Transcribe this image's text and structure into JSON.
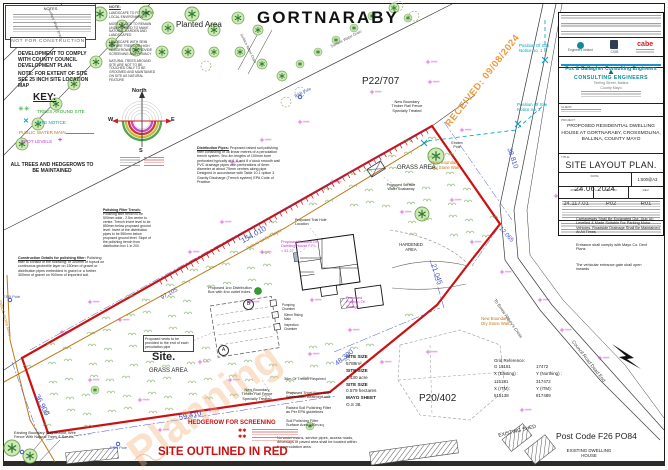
{
  "colors": {
    "red": "#cc1111",
    "blue_dim": "#4053c8",
    "cyan": "#00a0c0",
    "magenta": "#c433c4",
    "orange": "#c07818",
    "green_dark": "#2c7a2c",
    "green_fill": "#cfe8b8",
    "green_line": "#77aa55",
    "road": "#3a3a3a"
  },
  "header": {
    "townland": "GORTNARABY",
    "planted_area": "Planted Area"
  },
  "stamps": {
    "not_for_construction": "NOT FOR CONSTRUCTION",
    "received": "RECEIVED: 09/08/2024",
    "planning_watermark": "Planning"
  },
  "notes_box": {
    "title": "NOTES"
  },
  "dev_note": "DEVELOPMENT TO COMPLY WITH COUNTY COUNCIL DEVELOPMENT PLAN.",
  "extent_note": "NOTE: FOR EXTENT OF SITE SEE 25 INCH SITE LOCATION MAP",
  "key": {
    "title": "KEY:",
    "trees": "TREES AROUND SITE",
    "site_notice": "SITE NOTICE",
    "water_main": "PUBLIC WATER MAIN",
    "spot_levels": "SPOT LEVELS"
  },
  "trees_note": "ALL TREES AND HEDGEROWS TO BE MAINTAINED",
  "landscape_note": {
    "title": "NOTE:",
    "p1": "LANDSCAPE TO FIT IN WITH LOCAL ENVIRONMENT",
    "p2": "MOST OF SITE TO REMAIN UNDISTURBED TO MAKE NATURAL GARDEN AND LANDSCAPED",
    "p3": "LANDSCAPE WITH SEMI MATURE TREES OR HIGH HEDGEROWS TO PROVIDE SCREENING AND PRIVACY",
    "p4": "NATURAL TREES AROUND SITE ARE NOT TO BE TOUCHED ONLY TO BE GROOMED AND MAINTAINED ON SITE AS NATURAL FEATURE"
  },
  "compass": {
    "north_label": "North",
    "west": "W",
    "east": "E",
    "south": "S"
  },
  "notes": {
    "distribution_title": "Distribution Pipes:",
    "distribution_body": "Proposed raised soil polishing filter consisting of 36 linear metres of a percolation trench system. 9no 4m lengths of 100mm bore perforated typically at 4, 6 and 8 o'clock smooth wall PVC drainage pipes with perforations of 6mm diameter at about 75mm centres along pipe. Designed in accordance with Table 10.1 option 3 Gravity Discharge (Trench system) EPA Code of Practise.",
    "polishing_title": "Polishing Filter Trench:",
    "polishing_body": "Polishing filter trench to be 500mm wide - 2.5m centre to centre. Trench Invert level to be 850mm below proposed ground level. Invert of the distribution pipes to be 550mm below proposed ground level. Slope of the polishing trench from distribution box 1 in 200.",
    "construction_title": "Construction Details for polishing filter:",
    "construction_body": "Polishing filter to consist of the following: of 300mm of topsoil on continuous geotextile layer on 150mm of gravel or distribution pipes embedded in gravel or a further 300mm of gravel on 900mm of imported soil."
  },
  "parcels": {
    "p22": "P22/707",
    "p20": "P20/402"
  },
  "dims": {
    "road_frontage": "154.010",
    "nw": "97.105",
    "south": "59.410",
    "west": "36.900",
    "southeast": "48.390",
    "east": "21.045",
    "northeast": "38.810",
    "ne_short": "12.065"
  },
  "site": {
    "label": "Site.",
    "grass_area": "GRASS AREA",
    "hardened_area": "HARDENED AREA",
    "outlined": "SITE OUTLINED IN RED"
  },
  "labels": {
    "surface_water_drain": "Surface Water Drain",
    "esb_pole": "ESB Pole",
    "eircom_pole": "Eircom Pole",
    "new_boundary_fence": "New Boundary Timber Rail Fence Specially Treated",
    "dry_stone_wall": "New Boundary Dry Stone Wall",
    "soakaway": "Proposed Surface Water Soakaway",
    "dwelling": "Proposed Position Of Dwelling House F.F.L = 51.27",
    "garage": "Proposed Position Of Garage",
    "trial_hole": "Proposed Trial Hole Location",
    "dist_box": "Proposed 1no Distribution Box with 4no outlet holes.",
    "vents": "Proposed vents to be provided to the end of each percolation pipe",
    "pumping_chamber": "Pumping Chamber",
    "rising_main": "50mm Rising Main",
    "inspection_chamber": "Inspection Chamber",
    "a": "A",
    "b": "B",
    "site_notice1": "Position Of Site Notice no. 1",
    "site_notice2": "Position Of Site Notice no. 2",
    "council_road": "Council Road Dead End",
    "to_cross": "To Errew Abbey's Cross",
    "existing_shed": "EXISTING SHED",
    "existing_dwelling": "EXISTING DWELLING HOUSE",
    "post_code": "Post Code F26 PO84",
    "existing_boundary": "Existing Boundary Clay Mound, Wire Fence With Natural Trees & Scrubs.",
    "hedgerow": "HEDGEROW FOR SCREENING",
    "trench_req": "36m Of Trench Required",
    "treatment_unit": "Proposed Tricel Novo IE6+ Wastewater treatment unit",
    "raised_filter": "Raised Soil Polishing Filter as Per EPA guidelines",
    "filter_area": "Soil Polishing Filter Surface Area 140m.sq",
    "no_services": "No water mains, service pipes, access roads, driveways or paved area shall be located within the percolation area.",
    "carriageway": "Carriageway Shall Be Excavated Out, Dug Up Levelled & Made Suitable For Parking Motor Vehicles. Roadside Drainage Shall Be Maintained At All Times",
    "entrance": "Entrance shall comply with Mayo Co. Devt Plans",
    "gate": "The vehicular entrance gate shall open inwards"
  },
  "site_size": {
    "r1l": "SITE SIZE",
    "r1v": "5788m²",
    "r2l": "SITE SIZE",
    "r2v": "1.430 acre",
    "r3l": "SITE SIZE",
    "r3v": "0.579 hectares",
    "r4l": "MAYO SHEET",
    "r4v": "O.S 38."
  },
  "grid_reference": {
    "title": "Grid Reference:",
    "c1": "G 15181",
    "c2": "17472",
    "c3": "X (Easting) :",
    "c4": "Y (Northing) :",
    "c5": "115181",
    "c6": "317472",
    "c7": "X (ITM):",
    "c8": "Y (ITM):",
    "c9": "515138",
    "c10": "817489"
  },
  "title_block": {
    "firm": "Fox & Gallagher Consulting Engineers",
    "org": "CONSULTING ENGINEERS",
    "address1": "Teeling Street, Ballina",
    "address2": "County Mayo",
    "logo1": "Engineers Ireland",
    "logo2": "CIOB",
    "logo3": "cabe",
    "client_label": "CLIENT:",
    "project_label": "PROJECT:",
    "project": "PROPOSED RESIDENTIAL DWELLING HOUSE AT GORTNARABY, CROSSMOLINA, BALLINA, COUNTY MAYO",
    "title_label": "TITLE:",
    "title": "SITE LAYOUT PLAN.",
    "date_label": "DATE:",
    "date": "24.06.2024",
    "scale_label": "SCALE:",
    "scale": "1:500@A3",
    "job_label": "JOB NO.",
    "job": "24.117.01",
    "drg_label": "DRG NO.",
    "drg": "P02",
    "rev_label": "REV.",
    "rev": "R01"
  }
}
